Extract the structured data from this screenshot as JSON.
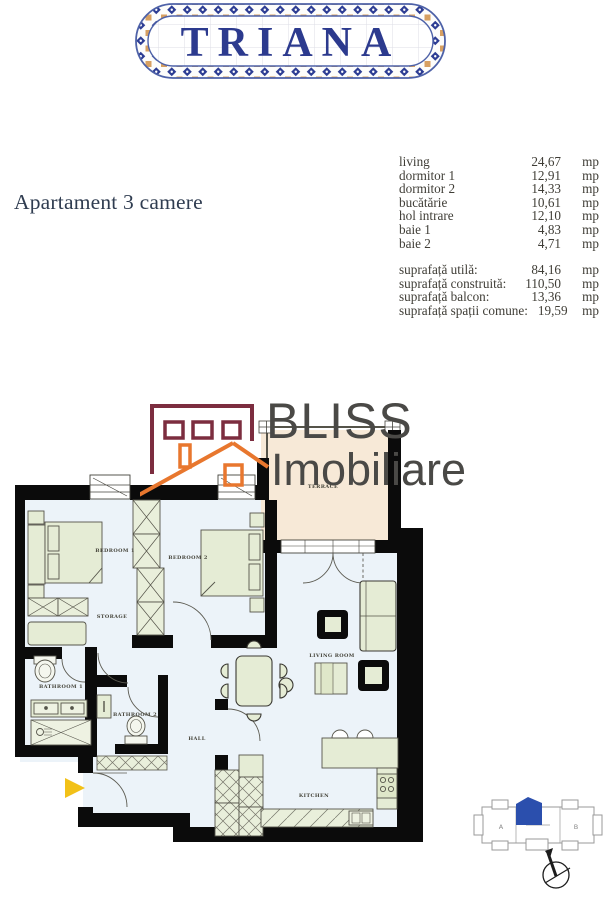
{
  "logo": {
    "text": "TRIANA"
  },
  "page_title": "Apartament 3 camere",
  "room_list": {
    "rows": [
      {
        "label": "living",
        "value": "24,67",
        "unit": "mp"
      },
      {
        "label": "dormitor 1",
        "value": "12,91",
        "unit": "mp"
      },
      {
        "label": "dormitor 2",
        "value": "14,33",
        "unit": "mp"
      },
      {
        "label": "bucătărie",
        "value": "10,61",
        "unit": "mp"
      },
      {
        "label": "hol intrare",
        "value": "12,10",
        "unit": "mp"
      },
      {
        "label": "baie 1",
        "value": "4,83",
        "unit": "mp"
      },
      {
        "label": "baie 2",
        "value": "4,71",
        "unit": "mp"
      }
    ]
  },
  "surface_list": {
    "rows": [
      {
        "label": "suprafață utilă:",
        "value": "84,16",
        "unit": "mp"
      },
      {
        "label": "suprafață construită:",
        "value": "110,50",
        "unit": "mp"
      },
      {
        "label": "suprafață balcon:",
        "value": "13,36",
        "unit": "mp"
      },
      {
        "label": "suprafață spații comune:",
        "value": "19,59",
        "unit": "mp"
      }
    ]
  },
  "watermark": {
    "brand_line1": "BLISS",
    "brand_line2": "Imobiliare"
  },
  "floorplan": {
    "labels": {
      "bedroom1": "BEDROOM 1",
      "bedroom2": "BEDROOM 2",
      "storage": "STORAGE",
      "bathroom1": "BATHROOM 1",
      "bathroom2": "BATHROOM 2",
      "hall": "HALL",
      "living_room": "LIVING ROOM",
      "kitchen": "KITCHEN",
      "terrace": "TERRACE"
    }
  },
  "key_plan": {
    "section_a": "A",
    "section_b": "B"
  },
  "colors": {
    "logo_navy": "#2c3a8e",
    "logo_tile_blue": "#4e62a8",
    "logo_tile_orange": "#d09048",
    "title_text": "#2f3c50",
    "list_text": "#3f3d36",
    "wall_black": "#0b0b0b",
    "floor_blue": "#ecf3f9",
    "furniture_green": "#e5ecd5",
    "terrace_beige": "#f7e9d7",
    "watermark_maroon": "#7c2d3f",
    "watermark_orange": "#e8772e",
    "watermark_gray": "#4a4946",
    "entrance_arrow_yellow": "#f2c118",
    "keyplan_unit_blue": "#2b4fad"
  }
}
